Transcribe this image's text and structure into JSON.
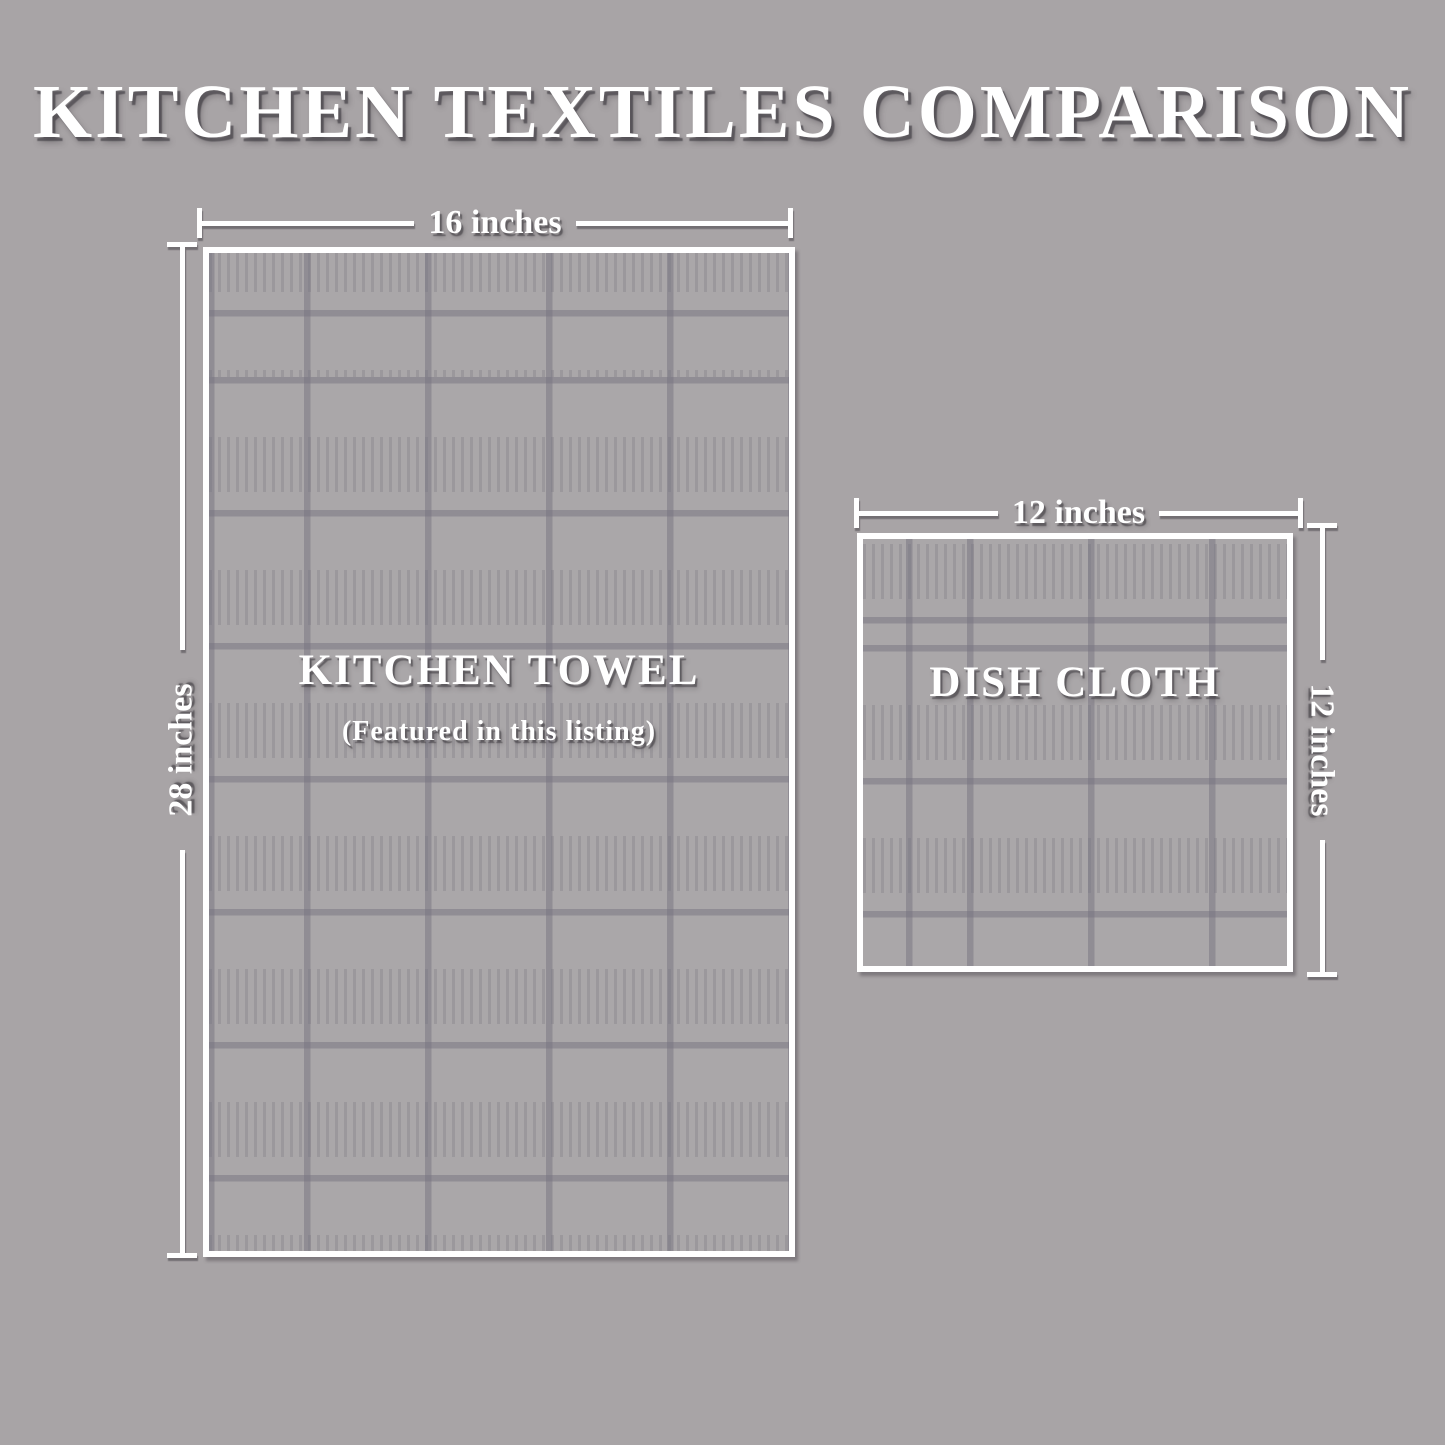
{
  "title": "KITCHEN TEXTILES COMPARISON",
  "towel": {
    "name": "KITCHEN TOWEL",
    "note": "(Featured in this listing)",
    "width_label": "16 inches",
    "height_label": "28 inches"
  },
  "dishcloth": {
    "name": "DISH CLOTH",
    "width_label": "12 inches",
    "height_label": "12 inches"
  },
  "colors": {
    "background": "#a8a4a6",
    "cloth_fill": "#aaa7a9",
    "grid_line": "#8f8c96",
    "text": "#ffffff",
    "shadow": "#3e3a40"
  }
}
